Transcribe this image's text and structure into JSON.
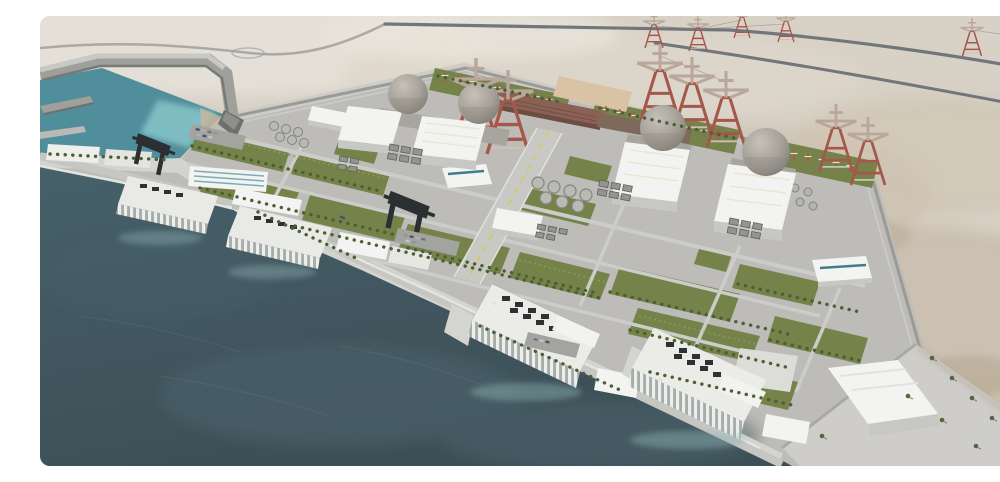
{
  "scene": {
    "type": "3d-architectural-aerial-rendering",
    "title": "Aerial 3D rendering of a four-unit coastal nuclear power plant on a desert shoreline, with harbor basin, breakwater, switchyard with lattice pylons, landscaped lawn grid and seawater intake structures",
    "landmarks": {
      "reactor_containment_domes": 4,
      "turbine_halls": 4,
      "seawater_intake_structures": 4,
      "gantry_cranes": 2,
      "tank_clusters": 3,
      "transmission_pylons_near": 7,
      "transmission_pylons_distant": 6,
      "harbor": "protected basin with breakwater, detached mole and quay wharf",
      "switchyard": "green strips with red-white gantry masts and tan laydown pad",
      "vegetation": "grid of lawns, tree-lined roads, palm rows on coastal apron"
    },
    "palette": {
      "sand": "#d8d1c6",
      "sand_light": "#e6e1d8",
      "sand_dark": "#bdb09c",
      "sea": "#42565e",
      "sea_light": "#4e656d",
      "harbor": "#4f8e9a",
      "harbor_shallow": "#8ecdd0",
      "concrete": "#bdbcb8",
      "concrete_light": "#cecdc9",
      "quay": "#c6c6c2",
      "road_dark": "#70767c",
      "white_building": "#f3f3f1",
      "building_shade": "#c7c7c3",
      "lawn": "#75834a",
      "tree": "#4c5e33",
      "dome": "#a9a59d",
      "brick": "#8a6154",
      "pylon_red": "#a4574a",
      "crane_dark": "#2c2f32",
      "tan_pad": "#d9c3a4",
      "lane_yellow": "#d9c94f"
    }
  }
}
